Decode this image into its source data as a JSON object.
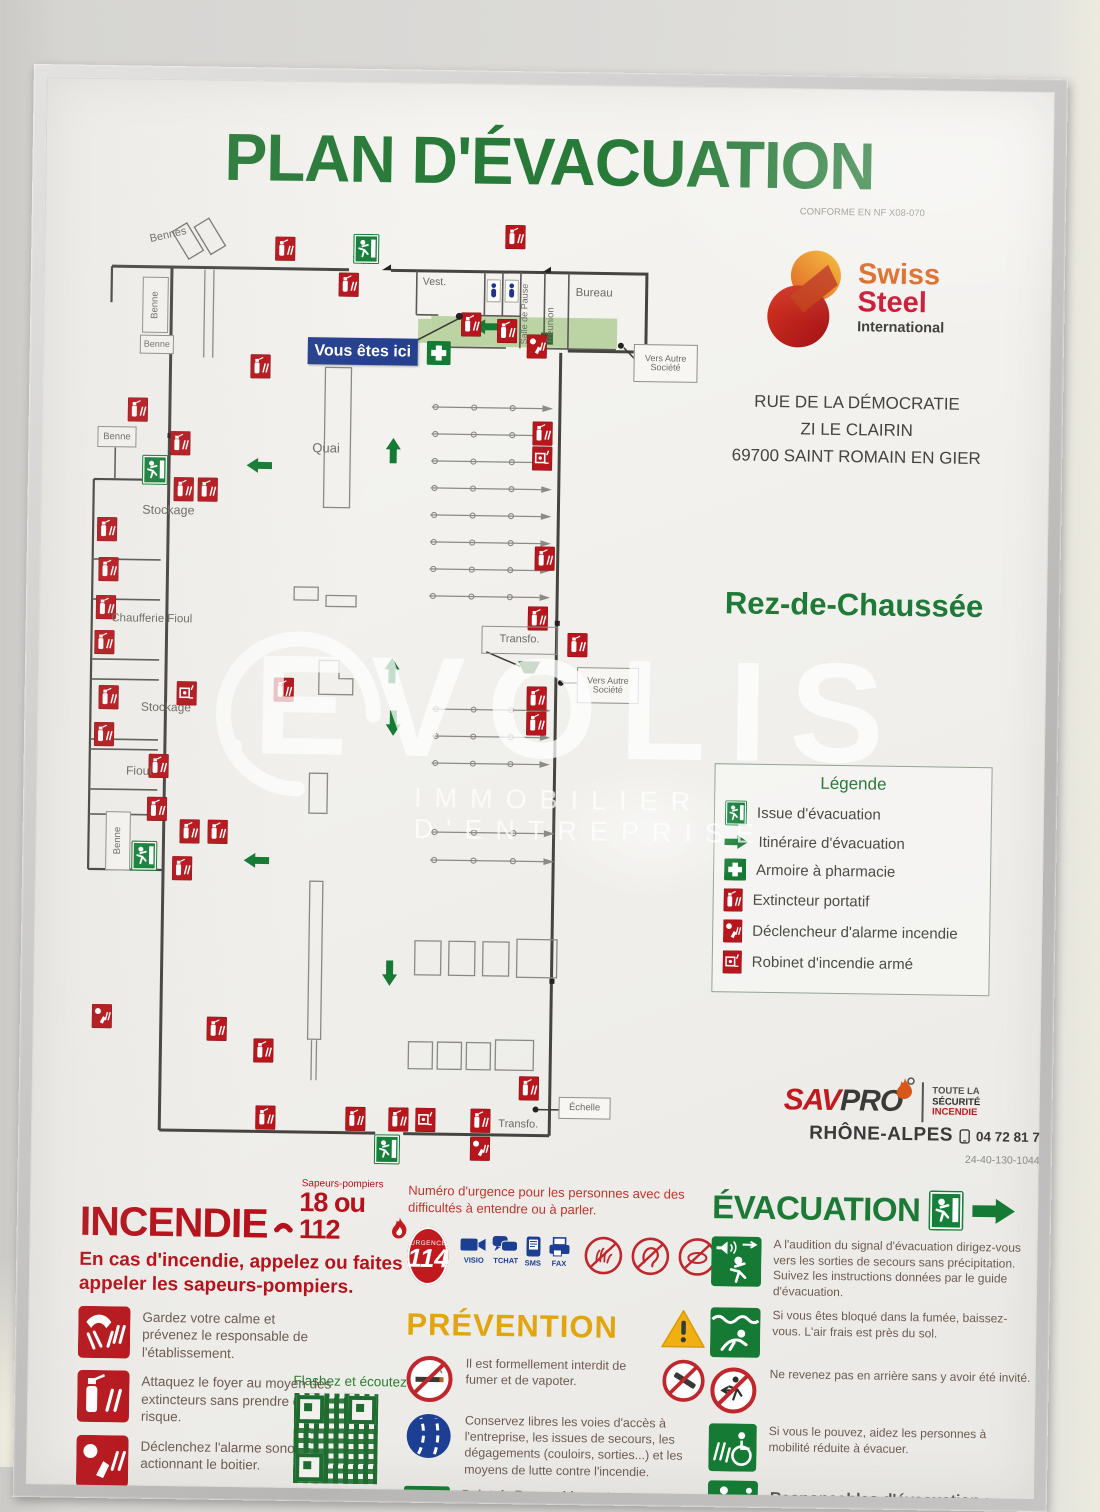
{
  "poster": {
    "title": "PLAN D'ÉVACUATION",
    "conformity": "CONFORME EN NF X08-070",
    "floor": "Rez-de-Chaussée"
  },
  "company": {
    "name_line1": "Swiss",
    "name_line2": "Steel",
    "name_line3": "International",
    "address": [
      "RUE DE LA DÉMOCRATIE",
      "ZI LE CLAIRIN",
      "69700 SAINT ROMAIN EN GIER"
    ]
  },
  "plan": {
    "you_are_here": "Vous êtes ici",
    "labels": {
      "bennes": "Bennes",
      "benne": "Benne",
      "vest": "Vest.",
      "salle_de_pause": "Salle de Pause",
      "reunion": "Réunion",
      "bureau": "Bureau",
      "quai": "Quai",
      "stockage": "Stockage",
      "chaufferie": "Chaufferie Fioul",
      "fioul": "Fioul",
      "transfo": "Transfo.",
      "vers_autre_societe": "Vers Autre Société",
      "echelle": "Échelle"
    }
  },
  "legend": {
    "title": "Légende",
    "items": [
      {
        "icon": "exit-icon",
        "label": "Issue d'évacuation"
      },
      {
        "icon": "arrow-icon",
        "label": "Itinéraire d'évacuation"
      },
      {
        "icon": "pharmacy-icon",
        "label": "Armoire à pharmacie"
      },
      {
        "icon": "extinguisher-icon",
        "label": "Extincteur portatif"
      },
      {
        "icon": "alarm-icon",
        "label": "Déclencheur d'alarme incendie"
      },
      {
        "icon": "ria-icon",
        "label": "Robinet d'incendie armé"
      }
    ]
  },
  "provider": {
    "brand_sav": "SAV",
    "brand_pro": "PRO",
    "region": "RHÔNE-ALPES",
    "tagline1": "TOUTE LA",
    "tagline2": "SÉCURITÉ",
    "tagline3": "INCENDIE",
    "phone": "04 72 81 71 71",
    "reference": "24-40-130-104448-A3-01",
    "date": "MAI 2024"
  },
  "incendie": {
    "title": "INCENDIE",
    "callout_small": "Sapeurs-pompiers",
    "numbers": "18 ou 112",
    "intro": "En cas d'incendie, appelez ou faites appeler les sapeurs-pompiers.",
    "steps": [
      "Gardez votre calme et prévenez le responsable de l'établissement.",
      "Attaquez le foyer au moyen des extincteurs sans prendre de risque.",
      "Déclenchez l'alarme sonore en actionnant le boitier."
    ],
    "qr_label": "Flashez et écoutez"
  },
  "urgence": {
    "text": "Numéro d'urgence pour les personnes avec des difficultés à entendre ou à parler.",
    "number": "114",
    "number_small": "URGENCE",
    "channels": [
      "VISIO",
      "TCHAT",
      "SMS",
      "FAX"
    ]
  },
  "prevention": {
    "title": "PRÉVENTION",
    "items": [
      "Il est formellement interdit de fumer et de vapoter.",
      "Conservez libres les voies d'accès à l'entreprise, les issues de secours, les dégagements (couloirs, sorties...) et les moyens de lutte contre l'incendie."
    ],
    "rassemblement": "Point de Rassemblement :"
  },
  "evacuation": {
    "title": "ÉVACUATION",
    "items": [
      "A l'audition du signal d'évacuation dirigez-vous vers les sorties de secours sans précipitation. Suivez les instructions données par le guide d'évacuation.",
      "Si vous êtes bloqué dans la fumée, baissez-vous. L'air frais est près du sol.",
      "Ne revenez pas en arrière sans y avoir été invité.",
      "Si vous le pouvez, aidez les personnes à mobilité réduite à évacuer.",
      "Responsables d'évacuation :"
    ]
  },
  "watermark": {
    "brand": "EVOLIS",
    "tagline": "IMMOBILIER D'ENTREPRISE"
  },
  "colors": {
    "green": "#1c7a36",
    "red": "#b5121b",
    "yellow": "#e2a50e",
    "blue": "#1c3f93"
  }
}
